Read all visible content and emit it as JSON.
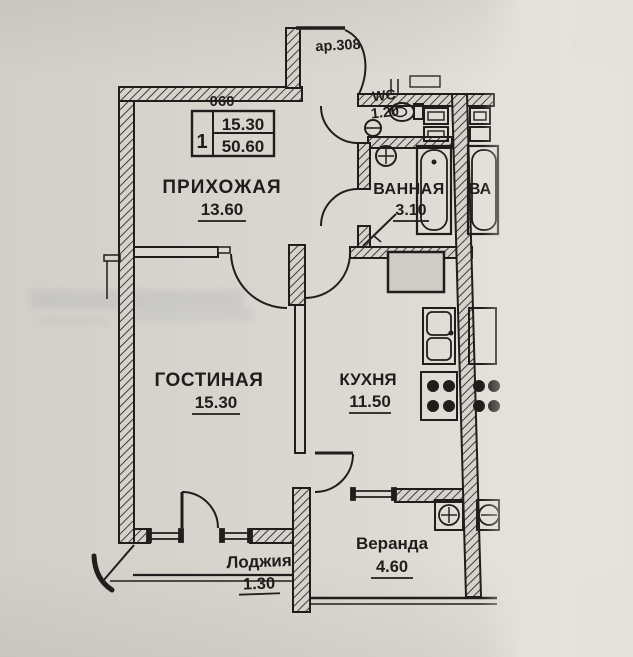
{
  "plan": {
    "entry_label": "ар.308",
    "info": {
      "number": "060",
      "rooms_count": "1",
      "living_area": "15.30",
      "total_area": "50.60"
    },
    "rooms": {
      "hallway": {
        "name": "ПРИХОЖАЯ",
        "area": "13.60"
      },
      "wc": {
        "name": "WC",
        "area": "1.20"
      },
      "bathroom": {
        "name": "ВАННАЯ",
        "area": "3.10"
      },
      "living": {
        "name": "ГОСТИНАЯ",
        "area": "15.30"
      },
      "kitchen": {
        "name": "КУХНЯ",
        "area": "11.50"
      },
      "loggia": {
        "name": "Лоджия",
        "area": "1.30"
      },
      "veranda": {
        "name": "Веранда",
        "area": "4.60"
      }
    },
    "neighbor": {
      "partial_label": "ВА"
    },
    "ink_color": "#1f1e1c",
    "paper_color": "#d8d5cf"
  }
}
